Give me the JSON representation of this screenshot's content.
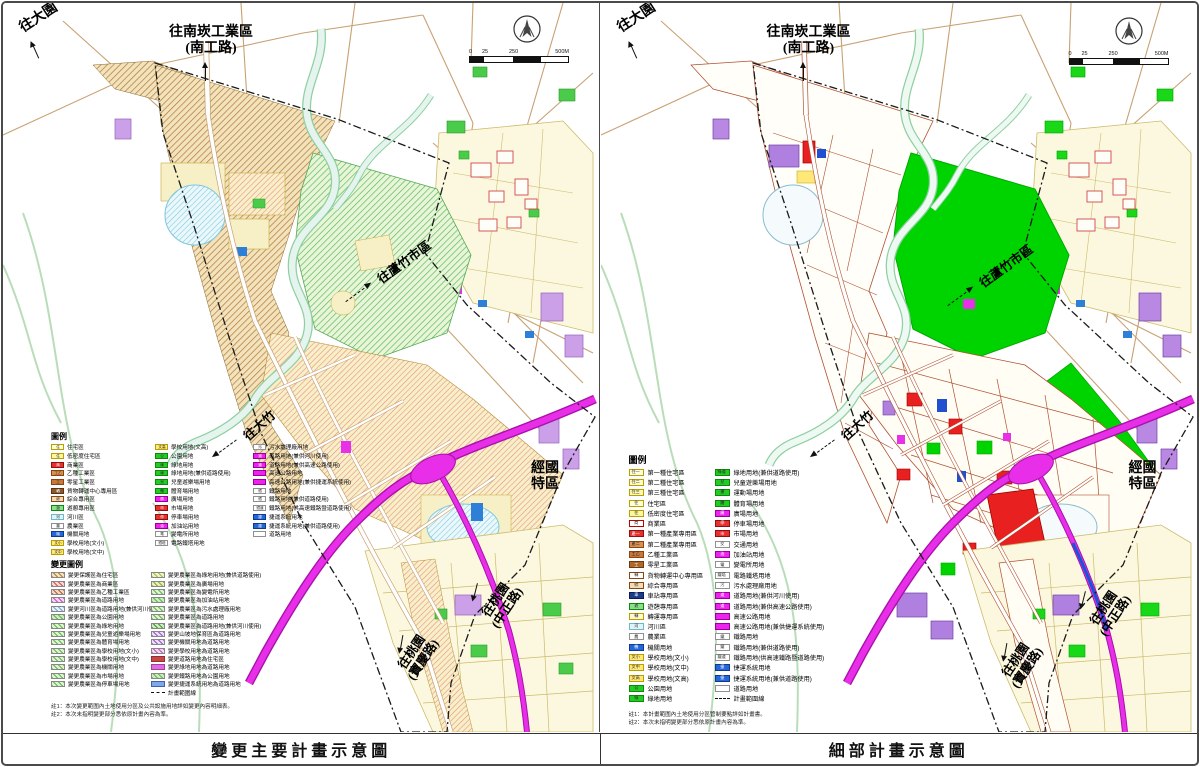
{
  "labels": {
    "to_dayuan": "往大園",
    "to_nankan_line1": "往南崁工業區",
    "to_nankan_line2": "(南工路)",
    "to_luzhu": "往蘆竹市區",
    "to_dazhu": "往大竹",
    "jingguo_line1": "經國",
    "jingguo_line2": "特區",
    "to_taoyuan_zz_line1": "往桃園",
    "to_taoyuan_zz_line2": "(中正路)",
    "to_taoyuan_bq_line1": "往桃園",
    "to_taoyuan_bq_line2": "(寶慶路)"
  },
  "scalebar": {
    "t0": "0",
    "t1": "25",
    "t2": "250",
    "t3": "500M"
  },
  "left_panel": {
    "caption": "變更主要計畫示意圖",
    "legend_title": "圖例",
    "change_legend_title": "變更圖例",
    "legend_columns": [
      [
        {
          "c": "#FFFFD8",
          "b": "#B8A000",
          "t": "住",
          "label": "住宅區"
        },
        {
          "c": "#FFF7A0",
          "b": "#B8A000",
          "t": "住",
          "label": "低密度住宅區"
        },
        {
          "c": "#E83030",
          "b": "#901010",
          "t": "商",
          "tc": "#fff",
          "label": "商業區"
        },
        {
          "c": "#D89050",
          "b": "#8B4513",
          "t": "工乙",
          "label": "乙種工業區"
        },
        {
          "c": "#C87838",
          "b": "#8B4513",
          "t": "工",
          "label": "零星工業區"
        },
        {
          "c": "#8B5A2B",
          "b": "#5C3317",
          "t": "轉",
          "tc": "#fff",
          "label": "貨物轉運中心專用區"
        },
        {
          "c": "#EFDDB5",
          "b": "#8B4513",
          "t": "綜",
          "label": "綜合專用區"
        },
        {
          "c": "#88E088",
          "b": "#108810",
          "t": "遊",
          "label": "遊憩專用區"
        },
        {
          "c": "#E0F4F8",
          "b": "#70B8C8",
          "t": "河",
          "label": "河川區"
        },
        {
          "c": "#FFFFFF",
          "b": "#909090",
          "t": "農",
          "label": "農業區"
        },
        {
          "c": "#2468D8",
          "b": "#103890",
          "t": "機",
          "tc": "#fff",
          "label": "機關用地"
        },
        {
          "c": "#FFE878",
          "b": "#B8A000",
          "t": "文小",
          "label": "學校用地(文小)"
        },
        {
          "c": "#FFE878",
          "b": "#B8A000",
          "t": "文中",
          "label": "學校用地(文中)"
        }
      ],
      [
        {
          "c": "#FFE878",
          "b": "#B8A000",
          "t": "文高",
          "label": "學校用地(文高)"
        },
        {
          "c": "#22CC22",
          "b": "#108810",
          "t": "公",
          "label": "公園用地"
        },
        {
          "c": "#22CC22",
          "b": "#108810",
          "t": "綠",
          "label": "綠地用地"
        },
        {
          "c": "#22CC22",
          "b": "#108810",
          "t": "綠",
          "label": "綠地用地(兼供道路使用)"
        },
        {
          "c": "#22CC22",
          "b": "#108810",
          "t": "兒",
          "label": "兒童遊樂場用地"
        },
        {
          "c": "#22CC22",
          "b": "#108810",
          "t": "體",
          "label": "體育場用地"
        },
        {
          "c": "#EE22EE",
          "b": "#990099",
          "t": "廣",
          "tc": "#fff",
          "label": "廣場用地"
        },
        {
          "c": "#E83030",
          "b": "#901010",
          "t": "市",
          "tc": "#fff",
          "label": "市場用地"
        },
        {
          "c": "#E83030",
          "b": "#901010",
          "t": "停",
          "tc": "#fff",
          "label": "停車場用地"
        },
        {
          "c": "#EE22EE",
          "b": "#990099",
          "t": "油",
          "tc": "#fff",
          "label": "加油站用地"
        },
        {
          "c": "#FFFFFF",
          "b": "#909090",
          "t": "電",
          "label": "變電所用地"
        },
        {
          "c": "#FFFFFF",
          "b": "#909090",
          "t": "鐵塔",
          "label": "電路鐵塔用地"
        }
      ],
      [
        {
          "c": "#FFFFFF",
          "b": "#909090",
          "t": "污",
          "label": "污水處理廠用地"
        },
        {
          "c": "#EE22EE",
          "b": "#990099",
          "t": "道",
          "tc": "#fff",
          "label": "道路用地(兼供河川使用)"
        },
        {
          "c": "#EE22EE",
          "b": "#990099",
          "t": "道",
          "tc": "#fff",
          "label": "道路用地(兼供高速公路使用)"
        },
        {
          "c": "#EE22EE",
          "b": "#990099",
          "t": "",
          "label": "高速公路用地"
        },
        {
          "c": "#EE22EE",
          "b": "#990099",
          "t": "",
          "label": "高速公路用地(兼供捷運系統使用)"
        },
        {
          "c": "#FFFFFF",
          "b": "#909090",
          "t": "鐵",
          "label": "鐵路用地"
        },
        {
          "c": "#FFFFFF",
          "b": "#909090",
          "t": "鐵",
          "label": "鐵路用地(兼供道路使用)"
        },
        {
          "c": "#FFFFFF",
          "b": "#909090",
          "t": "鐵道",
          "label": "鐵路用地(供高速鐵路暨道路使用)"
        },
        {
          "c": "#2468D8",
          "b": "#103890",
          "t": "捷",
          "tc": "#fff",
          "label": "捷運系統用地"
        },
        {
          "c": "#2468D8",
          "b": "#103890",
          "t": "捷",
          "tc": "#fff",
          "label": "捷運系統用地(兼供道路使用)"
        },
        {
          "c": "#FFFFFF",
          "b": "#909090",
          "t": "",
          "label": "道路用地"
        }
      ]
    ],
    "change_legend_columns": [
      [
        {
          "c": "#F2E3BC",
          "h": "#B07838",
          "label": "變更保護區為住宅區"
        },
        {
          "c": "#F6D6D6",
          "h": "#D05050",
          "label": "變更農業區為商業區"
        },
        {
          "c": "#F2D6C6",
          "h": "#B06030",
          "label": "變更農業區為乙種工業區"
        },
        {
          "c": "#F6D6F2",
          "h": "#C050C0",
          "label": "變更農業區為道路用地"
        },
        {
          "c": "#E6F2FA",
          "h": "#70A8D8",
          "label": "變更河川區為道路用地(兼供河川使用)"
        },
        {
          "c": "#CDECB8",
          "h": "#58B858",
          "label": "變更農業區為公園用地"
        },
        {
          "c": "#E2F2CC",
          "h": "#58B858",
          "label": "變更農業區為綠地用地"
        },
        {
          "c": "#E2F2CC",
          "h": "#58B858",
          "label": "變更農業區為兒童遊樂場用地"
        },
        {
          "c": "#E2F2CC",
          "h": "#58B858",
          "label": "變更農業區為體育場用地"
        },
        {
          "c": "#E2F2CC",
          "h": "#58B858",
          "label": "變更農業區為學校用地(文小)"
        },
        {
          "c": "#E2F2CC",
          "h": "#58B858",
          "label": "變更農業區為學校用地(文中)"
        },
        {
          "c": "#E2F2CC",
          "h": "#58B858",
          "label": "變更農業區為機關用地"
        },
        {
          "c": "#E2F2CC",
          "h": "#58B858",
          "label": "變更農業區為市場用地"
        },
        {
          "c": "#E2F2CC",
          "h": "#58B858",
          "label": "變更農業區為停車場用地"
        }
      ],
      [
        {
          "c": "#EDF6C2",
          "h": "#9CBE4A",
          "label": "變更農業區為綠地用地(兼供道路使用)"
        },
        {
          "c": "#E8EFB8",
          "h": "#88A838",
          "label": "變更農業區為廣場用地"
        },
        {
          "c": "#E2F2CC",
          "h": "#58B858",
          "label": "變更農業區為變電所用地"
        },
        {
          "c": "#CDECB8",
          "h": "#58B858",
          "label": "變更農業區為加油站用地"
        },
        {
          "c": "#E2F2CC",
          "h": "#58B858",
          "label": "變更農業區為污水處理廠用地"
        },
        {
          "c": "#E2F2CC",
          "h": "#58B858",
          "label": "變更農業區為道路用地"
        },
        {
          "c": "#D2E8C2",
          "h": "#389838",
          "label": "變更農業區為道路用地(兼供河川使用)"
        },
        {
          "c": "#EBDDF5",
          "h": "#9858C8",
          "label": "變更山坡地保育區為道路用地"
        },
        {
          "c": "#EBDDF5",
          "h": "#9858C8",
          "label": "變更機關用地為道路用地"
        },
        {
          "c": "#F6D6F2",
          "h": "#C050C0",
          "label": "變更學校用地為道路用地"
        },
        {
          "c": "#C84848",
          "b": "#903030",
          "label": "變更道路用地為住宅區"
        },
        {
          "c": "#E06AE0",
          "b": "#A040A0",
          "label": "變更綠地用地為道路用地"
        },
        {
          "c": "#CDECB8",
          "h": "#58B858",
          "label": "變更鐵路用地為公園用地"
        },
        {
          "c": "#7FA8E8",
          "b": "#4060B0",
          "label": "變更捷運系統用地為道路用地"
        },
        {
          "dash": true,
          "label": "計畫範圍線"
        }
      ]
    ],
    "notes": [
      "註1：本次變更範圍內土地使用分區及公共設施用地詳如變更內容明細表。",
      "註2：本次未指明變更部分悉依原計畫內容為準。"
    ]
  },
  "right_panel": {
    "caption": "細部計畫示意圖",
    "legend_title": "圖例",
    "legend_columns": [
      [
        {
          "c": "#FFFFE0",
          "b": "#B8A000",
          "t": "住一",
          "label": "第一種住宅區"
        },
        {
          "c": "#FFFCC8",
          "b": "#B8A000",
          "t": "住二",
          "label": "第二種住宅區"
        },
        {
          "c": "#FFF8B0",
          "b": "#B8A000",
          "t": "住三",
          "label": "第三種住宅區"
        },
        {
          "c": "#FFFFD8",
          "b": "#B8A000",
          "t": "住",
          "label": "住宅區"
        },
        {
          "c": "#FFF7A0",
          "b": "#B8A000",
          "t": "住",
          "label": "低密度住宅區"
        },
        {
          "c": "#FFFFFF",
          "b": "#C00000",
          "t": "商",
          "label": "商業區"
        },
        {
          "c": "#E83030",
          "b": "#901010",
          "t": "產一",
          "tc": "#fff",
          "label": "第一種產業專用區"
        },
        {
          "c": "#D89050",
          "b": "#8B4513",
          "t": "產二",
          "label": "第二種產業專用區"
        },
        {
          "c": "#C87838",
          "b": "#8B4513",
          "t": "工乙",
          "label": "乙種工業區"
        },
        {
          "c": "#B06828",
          "b": "#6B3A13",
          "t": "工",
          "tc": "#fff",
          "label": "零星工業區"
        },
        {
          "c": "#FFFFFF",
          "b": "#8B4513",
          "t": "轉",
          "label": "貨物轉運中心專用區"
        },
        {
          "c": "#EFDDB5",
          "b": "#8B4513",
          "t": "綜",
          "label": "綜合專用區"
        },
        {
          "c": "#1A3C8C",
          "b": "#0A1C50",
          "t": "車",
          "tc": "#fff",
          "label": "車站專用區"
        },
        {
          "c": "#88E088",
          "b": "#108810",
          "t": "遊",
          "label": "遊憩專用區"
        },
        {
          "c": "#FFF8D0",
          "b": "#B8A000",
          "t": "轉",
          "label": "轉運專用區"
        },
        {
          "c": "#E0F4F8",
          "b": "#70B8C8",
          "t": "河",
          "label": "河川區"
        },
        {
          "c": "#FFFFFF",
          "b": "#909090",
          "t": "農",
          "label": "農業區"
        },
        {
          "c": "#2468D8",
          "b": "#103890",
          "t": "機",
          "tc": "#fff",
          "label": "機關用地"
        },
        {
          "c": "#FFE878",
          "b": "#B8A000",
          "t": "文小",
          "label": "學校用地(文小)"
        },
        {
          "c": "#FFE878",
          "b": "#B8A000",
          "t": "文中",
          "label": "學校用地(文中)"
        },
        {
          "c": "#FFE878",
          "b": "#B8A000",
          "t": "文高",
          "label": "學校用地(文高)"
        },
        {
          "c": "#22CC22",
          "b": "#108810",
          "t": "公",
          "label": "公園用地"
        },
        {
          "c": "#22CC22",
          "b": "#108810",
          "t": "綠",
          "label": "綠地用地"
        }
      ],
      [
        {
          "c": "#22CC22",
          "b": "#108810",
          "t": "綠道",
          "label": "綠地用地(兼供道路使用)"
        },
        {
          "c": "#22CC22",
          "b": "#108810",
          "t": "兒",
          "label": "兒童遊樂場用地"
        },
        {
          "c": "#22CC22",
          "b": "#108810",
          "t": "運",
          "label": "運動場用地"
        },
        {
          "c": "#22CC22",
          "b": "#108810",
          "t": "體",
          "label": "體育場用地"
        },
        {
          "c": "#EE22EE",
          "b": "#990099",
          "t": "廣",
          "tc": "#fff",
          "label": "廣場用地"
        },
        {
          "c": "#E83030",
          "b": "#901010",
          "t": "停",
          "tc": "#fff",
          "label": "停車場用地"
        },
        {
          "c": "#E83030",
          "b": "#901010",
          "t": "市",
          "tc": "#fff",
          "label": "市場用地"
        },
        {
          "c": "#FFFFFF",
          "b": "#909090",
          "t": "交",
          "label": "交通用地"
        },
        {
          "c": "#EE22EE",
          "b": "#990099",
          "t": "油",
          "tc": "#fff",
          "label": "加油站用地"
        },
        {
          "c": "#FFFFFF",
          "b": "#909090",
          "t": "電",
          "label": "變電所用地"
        },
        {
          "c": "#FFFFFF",
          "b": "#909090",
          "t": "鐵塔",
          "label": "電路鐵塔用地"
        },
        {
          "c": "#FFFFFF",
          "b": "#909090",
          "t": "污",
          "label": "污水處理廠用地"
        },
        {
          "c": "#EE22EE",
          "b": "#990099",
          "t": "道",
          "tc": "#fff",
          "label": "道路用地(兼供河川使用)"
        },
        {
          "c": "#EE22EE",
          "b": "#990099",
          "t": "道",
          "tc": "#fff",
          "label": "道路用地(兼供高速公路使用)"
        },
        {
          "c": "#EE22EE",
          "b": "#990099",
          "t": "",
          "label": "高速公路用地"
        },
        {
          "c": "#EE22EE",
          "b": "#990099",
          "t": "",
          "label": "高速公路用地(兼供捷運系統使用)"
        },
        {
          "c": "#FFFFFF",
          "b": "#909090",
          "t": "鐵",
          "label": "鐵路用地"
        },
        {
          "c": "#FFFFFF",
          "b": "#909090",
          "t": "鐵",
          "label": "鐵路用地(兼供道路使用)"
        },
        {
          "c": "#FFFFFF",
          "b": "#909090",
          "t": "鐵道",
          "label": "鐵路用地(供高速鐵路暨道路使用)"
        },
        {
          "c": "#2468D8",
          "b": "#103890",
          "t": "捷",
          "tc": "#fff",
          "label": "捷運系統用地"
        },
        {
          "c": "#2468D8",
          "b": "#103890",
          "t": "捷",
          "tc": "#fff",
          "label": "捷運系統用地(兼供道路使用)"
        },
        {
          "c": "#FFFFFF",
          "b": "#909090",
          "t": "",
          "label": "道路用地"
        },
        {
          "dash": true,
          "label": "計畫範圍線"
        }
      ]
    ],
    "notes": [
      "註1：本計畫範圍內土地使用分區管制要點詳如計畫書。",
      "註2：本次未指明變更部分悉依原計畫內容為準。"
    ]
  }
}
